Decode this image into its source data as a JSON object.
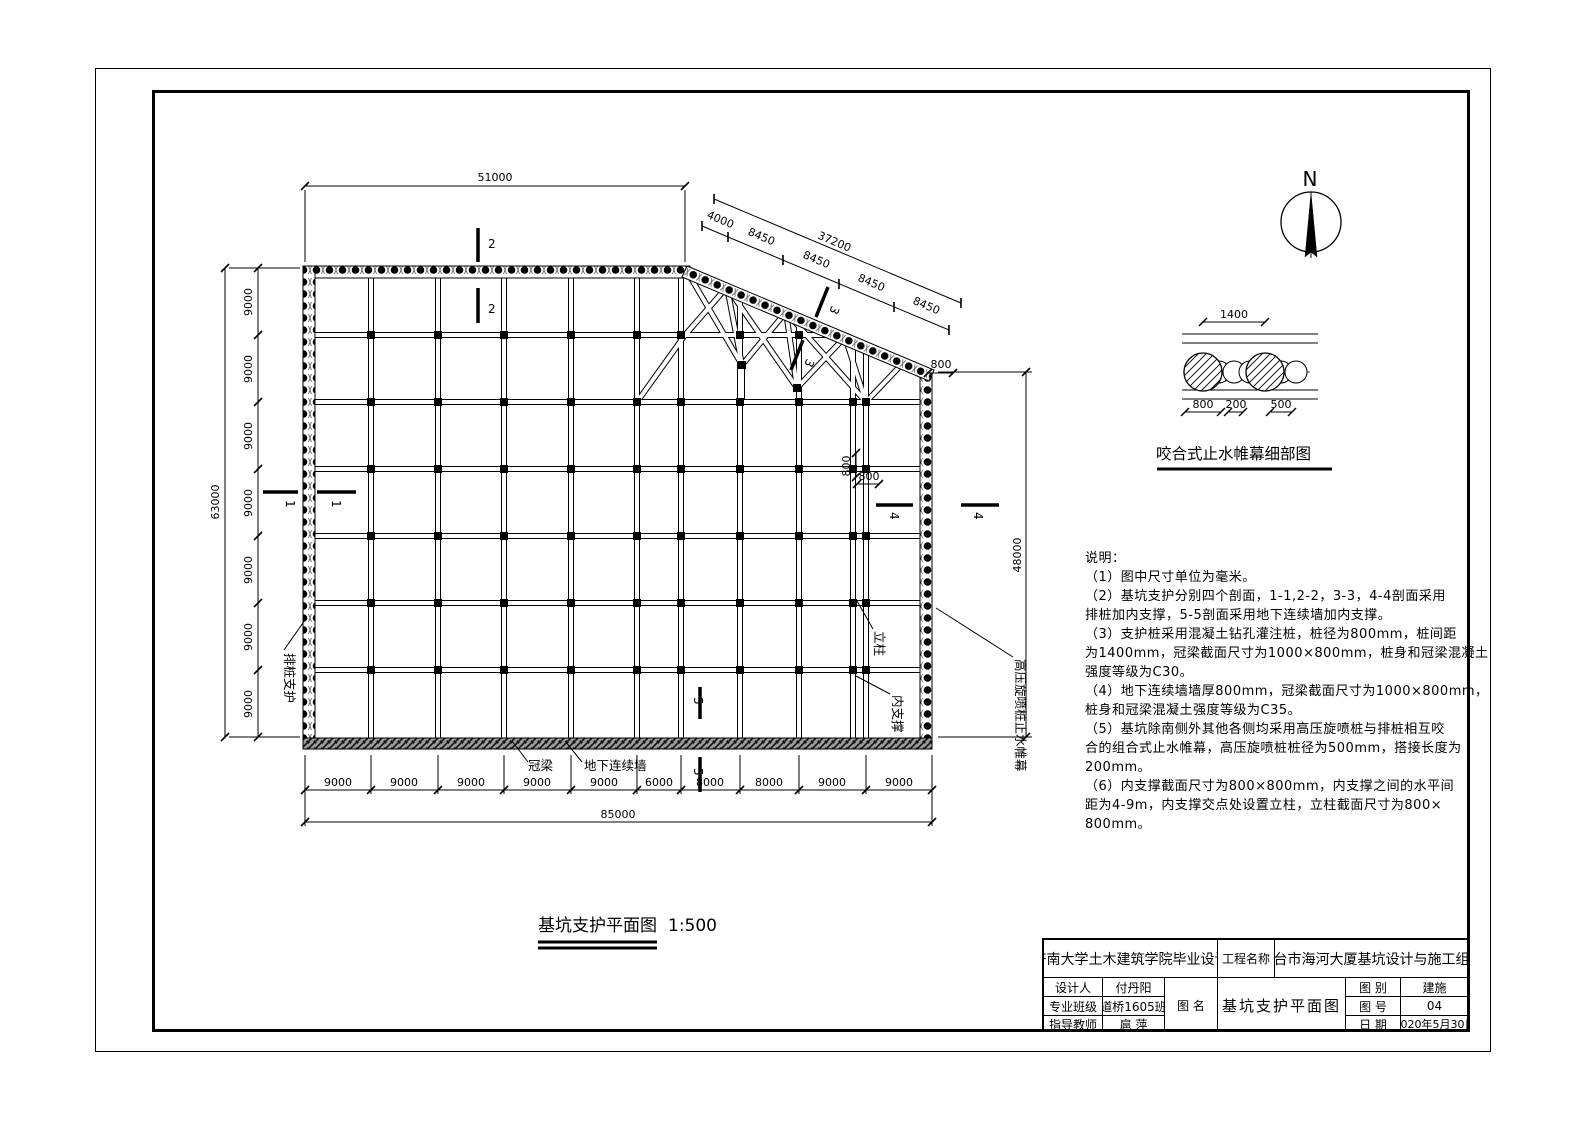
{
  "north": {
    "label": "N"
  },
  "plan": {
    "caption": {
      "title": "基坑支护平面图",
      "scale": "1:500"
    },
    "dims": {
      "top_total": "51000",
      "diag_total": "37200",
      "diag_segments": [
        "4000",
        "8450",
        "8450",
        "8450",
        "8450"
      ],
      "right_total": "48000",
      "left_total": "63000",
      "left_segments": [
        "9000",
        "9000",
        "9000",
        "9000",
        "9000",
        "9000",
        "9000"
      ],
      "bottom_segments": [
        "9000",
        "9000",
        "9000",
        "9000",
        "9000",
        "6000",
        "8000",
        "8000",
        "9000",
        "9000"
      ],
      "bottom_total": "85000",
      "wall_800": "800",
      "mid_800_v": "800",
      "mid_800_h": "800"
    },
    "sections": {
      "s1": "1",
      "s2": "2",
      "s3": "3",
      "s4": "4",
      "s5": "5"
    },
    "labels": {
      "pile_support": "排桩支护",
      "column": "立柱",
      "strut": "内支撑",
      "jet_curtain": "高压旋喷桩止水帷幕",
      "crown_beam": "冠梁",
      "diaphragm_wall": "地下连续墙"
    }
  },
  "detail": {
    "title": "咬合式止水帷幕细部图",
    "dim_top": "1400",
    "dim_b1": "800",
    "dim_b2": "200",
    "dim_b3": "500"
  },
  "notes": {
    "title": "说明：",
    "lines": [
      "（1）图中尺寸单位为毫米。",
      "（2）基坑支护分别四个剖面，1-1,2-2，3-3，4-4剖面采用",
      "排桩加内支撑，5-5剖面采用地下连续墙加内支撑。",
      "（3）支护桩采用混凝土钻孔灌注桩，桩径为800mm，桩间距",
      "为1400mm，冠梁截面尺寸为1000×800mm，桩身和冠梁混凝土",
      "强度等级为C30。",
      "（4）地下连续墙墙厚800mm，冠梁截面尺寸为1000×800mm，",
      "桩身和冠梁混凝土强度等级为C35。",
      "（5）基坑除南侧外其他各侧均采用高压旋喷桩与排桩相互咬",
      "合的组合式止水帷幕，高压旋喷桩桩径为500mm，搭接长度为",
      "200mm。",
      "（6）内支撑截面尺寸为800×800mm，内支撑之间的水平间",
      "距为4-9m，内支撑交点处设置立柱，立柱截面尺寸为800×",
      "800mm。"
    ]
  },
  "titleblock": {
    "university": "济南大学土木建筑学院毕业设计",
    "project_label": "工程名称",
    "project_name": "烟台市海河大厦基坑设计与施工组织",
    "rows": [
      {
        "label": "设计人",
        "value": "付丹阳"
      },
      {
        "label": "专业班级",
        "value": "道桥1605班"
      },
      {
        "label": "指导教师",
        "value": "扈 萍"
      }
    ],
    "fig_name_label": "图 名",
    "fig_name": "基坑支护平面图",
    "right_rows": [
      {
        "label": "图 别",
        "value": "建施"
      },
      {
        "label": "图 号",
        "value": "04"
      },
      {
        "label": "日 期",
        "value": "2020年5月30日"
      }
    ]
  }
}
